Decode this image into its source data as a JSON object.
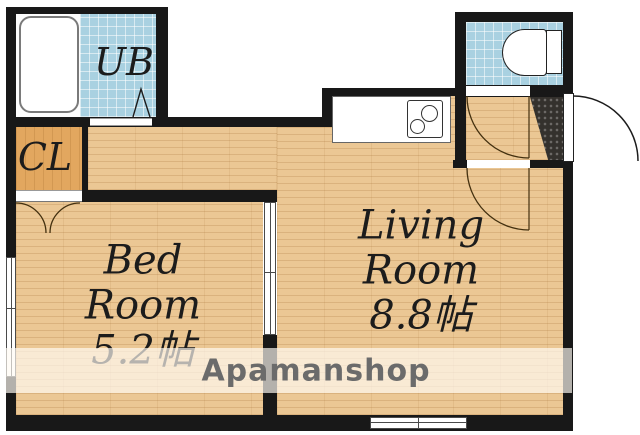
{
  "floorplan": {
    "rooms": {
      "unit_bath": {
        "label": "UB"
      },
      "closet": {
        "label": "CL"
      },
      "bedroom": {
        "line1": "Bed",
        "line2": "Room",
        "size": "5.2帖"
      },
      "living_room": {
        "line1": "Living",
        "line2": "Room",
        "size": "8.8帖"
      }
    },
    "watermark": "Apamanshop",
    "colors": {
      "wood_floor": "#ebc794",
      "closet_floor": "#e2a75f",
      "bath_tile": "#a9d1e1",
      "wall": "#181818",
      "entrance_tile": "#34312d",
      "watermark_text": "#6b6b6b",
      "watermark_band": "rgba(255,251,243,0.68)"
    }
  }
}
